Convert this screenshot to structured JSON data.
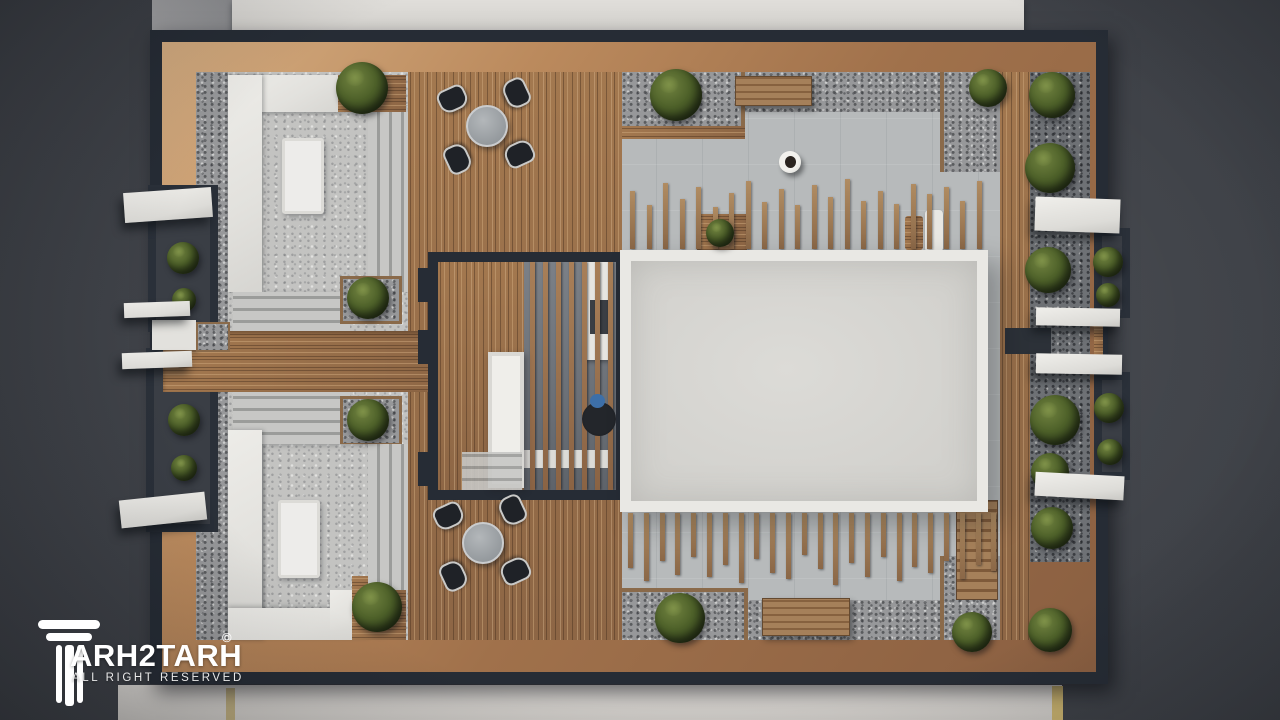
{
  "watermark": {
    "brand_text": "ARH2TARH",
    "brand_full": "TARH2TARH",
    "copyright": "©",
    "tagline": "ALL RIGHT RESERVED",
    "logo": "column-logo-icon",
    "color": "#ffffff"
  },
  "palette": {
    "asphalt": "#3c3f45",
    "asphalt_dark": "#2c2f34",
    "sidewalk_top": "#d9d7d3",
    "sidewalk_bottom": "#d0cdc9",
    "frame_dark": "#262c35",
    "wood_light": "#d5ad81",
    "wood_mid": "#a0714b",
    "deck_wood": "#9a7150",
    "gravel": "#97989a",
    "concrete": "#b7babb",
    "white_surface": "#e7e6e2",
    "slab_field": "#d8d7d3",
    "bush_green": "#4d6029",
    "chair_black": "#1f2227",
    "table_gray": "#9fa4a7",
    "person_blue": "#3d6fa8",
    "trim_yellow": "#c3ad6c"
  },
  "scene": {
    "description": "Top-down aerial 3D render of a rooftop terrace: white lounge platforms, wood deck with two dining sets, slatted pergola skylight, large white roof slab, timber post screens, planters with shrubs, side balconies with white awnings",
    "upper_posts": {
      "x": 630,
      "spacing": 16.5,
      "bottom_y": 249,
      "width": 5,
      "heights": [
        58,
        44,
        66,
        50,
        62,
        42,
        56,
        68,
        47,
        60,
        44,
        64,
        52,
        70,
        48,
        58,
        45,
        65,
        55,
        62,
        48,
        68
      ]
    },
    "lower_posts": {
      "x": 628,
      "spacing": 15.8,
      "top_y": 513,
      "width": 5,
      "heights": [
        55,
        68,
        48,
        62,
        44,
        64,
        52,
        70,
        46,
        60,
        66,
        42,
        56,
        72,
        50,
        64,
        44,
        68,
        54,
        60,
        48,
        66,
        52,
        58
      ]
    },
    "pergola_slats": {
      "x0": 6,
      "spacing": 13,
      "count": 7,
      "width": 5,
      "top": 0,
      "height": 228
    },
    "bushes": [
      [
        362,
        88,
        26
      ],
      [
        368,
        298,
        21
      ],
      [
        368,
        420,
        21
      ],
      [
        377,
        607,
        25
      ],
      [
        676,
        95,
        26
      ],
      [
        720,
        233,
        14
      ],
      [
        988,
        88,
        19
      ],
      [
        1052,
        95,
        23
      ],
      [
        1050,
        168,
        25
      ],
      [
        1048,
        270,
        23
      ],
      [
        1055,
        420,
        25
      ],
      [
        1050,
        472,
        19
      ],
      [
        680,
        618,
        25
      ],
      [
        972,
        632,
        20
      ],
      [
        1050,
        630,
        22
      ],
      [
        1052,
        528,
        21
      ],
      [
        183,
        258,
        16
      ],
      [
        184,
        300,
        12
      ],
      [
        184,
        420,
        16
      ],
      [
        184,
        468,
        13
      ],
      [
        1108,
        262,
        15
      ],
      [
        1108,
        295,
        12
      ],
      [
        1109,
        408,
        15
      ],
      [
        1110,
        452,
        13
      ]
    ],
    "dining_sets": [
      {
        "x": 487,
        "y": 126
      },
      {
        "x": 483,
        "y": 543
      }
    ],
    "persons": [
      {
        "x": 790,
        "y": 162,
        "variant": "walker",
        "parent": "stage"
      },
      {
        "x": 58,
        "y": 140,
        "variant": "seated",
        "parent": "pergola"
      }
    ]
  }
}
